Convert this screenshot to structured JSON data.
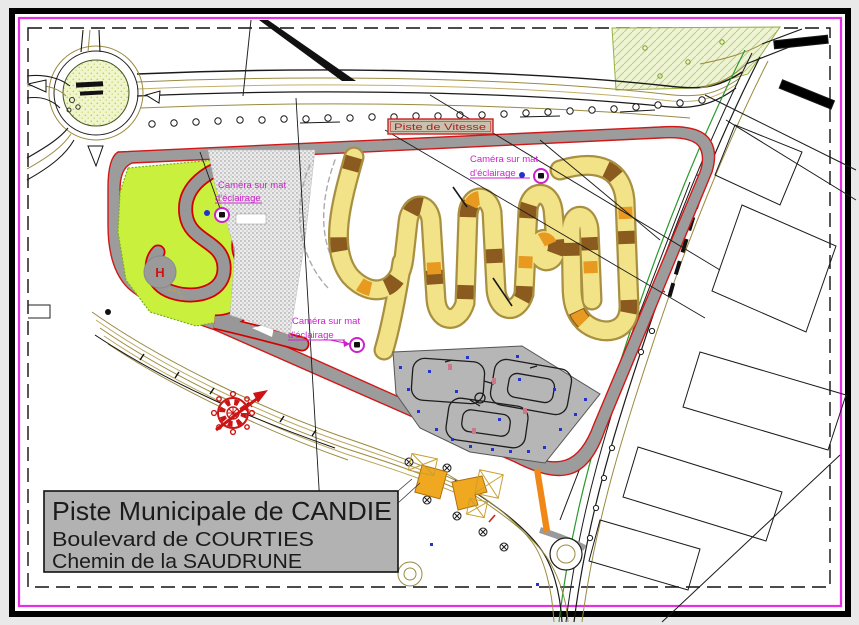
{
  "document": {
    "kind": "CAD site plan drawing",
    "title_block": {
      "line1": "Piste Municipale de CANDIE",
      "line2": "Boulevard de COURTIES",
      "line3": "Chemin de la SAUDRUNE"
    },
    "track_label": "Piste de Vitesse",
    "camera_label": {
      "line1": "Caméra sur mat",
      "line2": "d'éclairage"
    },
    "helipad_letter": "H"
  },
  "colors": {
    "canvas_bg": "#e9e9e9",
    "paper": "#ffffff",
    "frame_black": "#000000",
    "sheet_border_magenta": "#e62ee6",
    "track_edge_red": "#d01818",
    "asphalt_gray": "#9c9c9c",
    "infield_green": "#c8f03c",
    "kart_yellow": "#f2e388",
    "kart_casing_tan": "#a89040",
    "kart_brown": "#8a5a1e",
    "kart_orange": "#e89a20",
    "road_olive": "#9a8a40",
    "road_green": "#2a9a2a",
    "label_magenta": "#cc22cc",
    "compass_red": "#cc1414",
    "title_block_bg": "#b2b2b2",
    "field_green": "#eef3d6",
    "marker_blue": "#2233cc",
    "building_orange": "#f0a820"
  }
}
